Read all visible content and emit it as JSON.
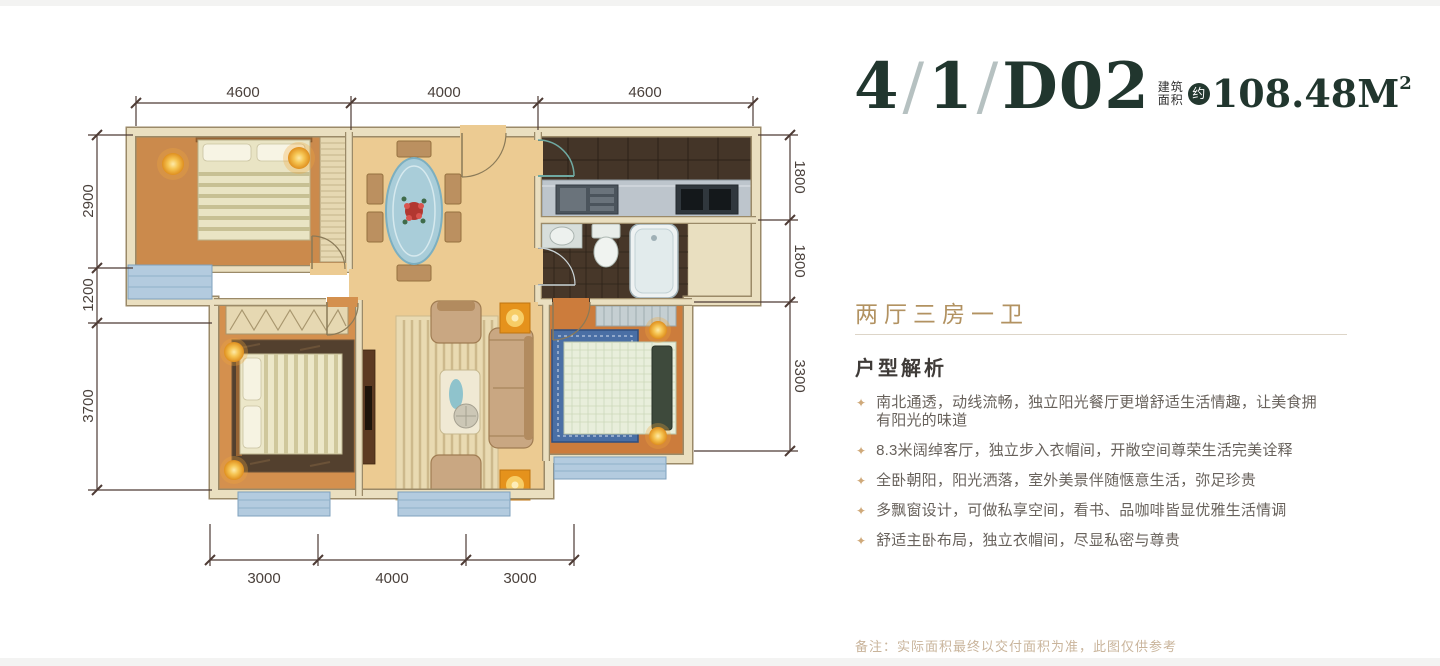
{
  "header": {
    "unit_parts": [
      "4",
      "/",
      "1",
      "/",
      "D02"
    ],
    "area_label_top": "建筑",
    "area_label_bottom": "面积",
    "area_badge": "约",
    "area_number": "108.48",
    "area_unit": "M",
    "area_sup": "2"
  },
  "summary": {
    "layout_title": "两厅三房一卫",
    "analysis_title": "户型解析",
    "bullet_marker": "✦",
    "bullets": [
      "南北通透，动线流畅，独立阳光餐厅更增舒适生活情趣，让美食拥有阳光的味道",
      "8.3米阔绰客厅，独立步入衣帽间，开敞空间尊荣生活完美诠释",
      "全卧朝阳，阳光洒落，室外美景伴随惬意生活，弥足珍贵",
      "多飘窗设计，可做私享空间，看书、品咖啡皆显优雅生活情调",
      "舒适主卧布局，独立衣帽间，尽显私密与尊贵"
    ],
    "note": "备注：实际面积最终以交付面积为准，此图仅供参考"
  },
  "floorplan": {
    "dims_top": [
      "4600",
      "4000",
      "4600"
    ],
    "dims_bottom": [
      "3000",
      "4000",
      "3000"
    ],
    "dims_left": [
      "2900",
      "1200",
      "3700"
    ],
    "dims_right": [
      "1800",
      "1800",
      "3300"
    ]
  },
  "colors": {
    "accent_green": "#21362e",
    "accent_gold": "#b29261",
    "dim_line": "#4e3b35"
  }
}
